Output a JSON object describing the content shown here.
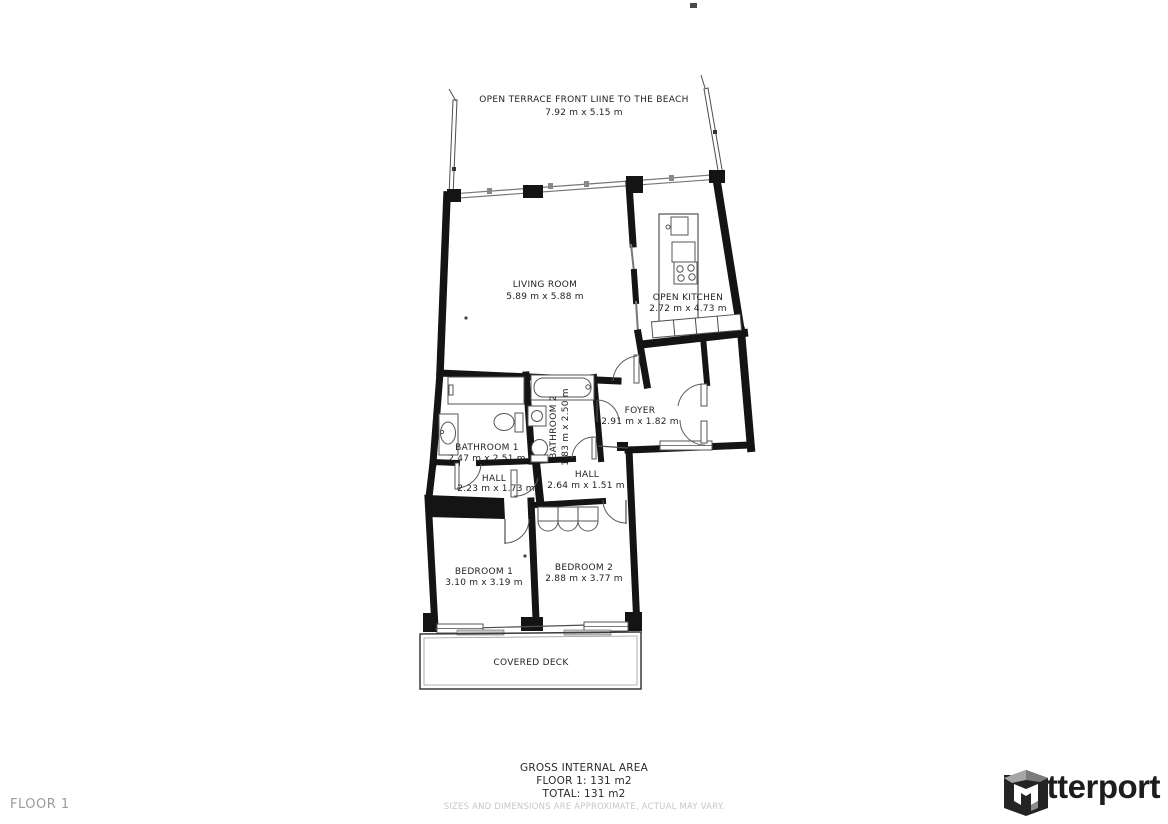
{
  "floorplan": {
    "rooms": {
      "terrace": {
        "name": "OPEN TERRACE FRONT LIINE TO THE BEACH",
        "dims": "7.92 m x 5.15 m"
      },
      "living_room": {
        "name": "LIVING ROOM",
        "dims": "5.89 m x 5.88 m"
      },
      "open_kitchen": {
        "name": "OPEN KITCHEN",
        "dims": "2.72 m x 4.73 m"
      },
      "foyer": {
        "name": "FOYER",
        "dims": "2.91 m x 1.82 m"
      },
      "bathroom1": {
        "name": "BATHROOM 1",
        "dims": "2.47 m x 2.51 m"
      },
      "bathroom2": {
        "name": "BATHROOM 2",
        "dims": "1.83 m x 2.50 m"
      },
      "hall1": {
        "name": "HALL",
        "dims": "2.23 m x 1.73 m"
      },
      "hall2": {
        "name": "HALL",
        "dims": "2.64 m x 1.51 m"
      },
      "bedroom1": {
        "name": "BEDROOM 1",
        "dims": "3.10 m x 3.19 m"
      },
      "bedroom2": {
        "name": "BEDROOM 2",
        "dims": "2.88 m x 3.77 m"
      },
      "covered_deck": {
        "name": "COVERED DECK"
      }
    }
  },
  "footer": {
    "floor_label": "FLOOR 1",
    "area_title": "GROSS INTERNAL AREA",
    "area_floor": "FLOOR 1: 131 m2",
    "area_total": "TOTAL: 131 m2",
    "disclaimer": "SIZES AND DIMENSIONS ARE APPROXIMATE, ACTUAL MAY VARY."
  },
  "branding": {
    "wordmark": "Matterport"
  },
  "colors": {
    "wall": "#141414",
    "thin_line": "#4d4d4d",
    "label_text": "#1f1f1f",
    "muted_text": "#c7c7c7",
    "floor_label_text": "#9b9b9b",
    "logo_text": "#1d1d1f"
  }
}
